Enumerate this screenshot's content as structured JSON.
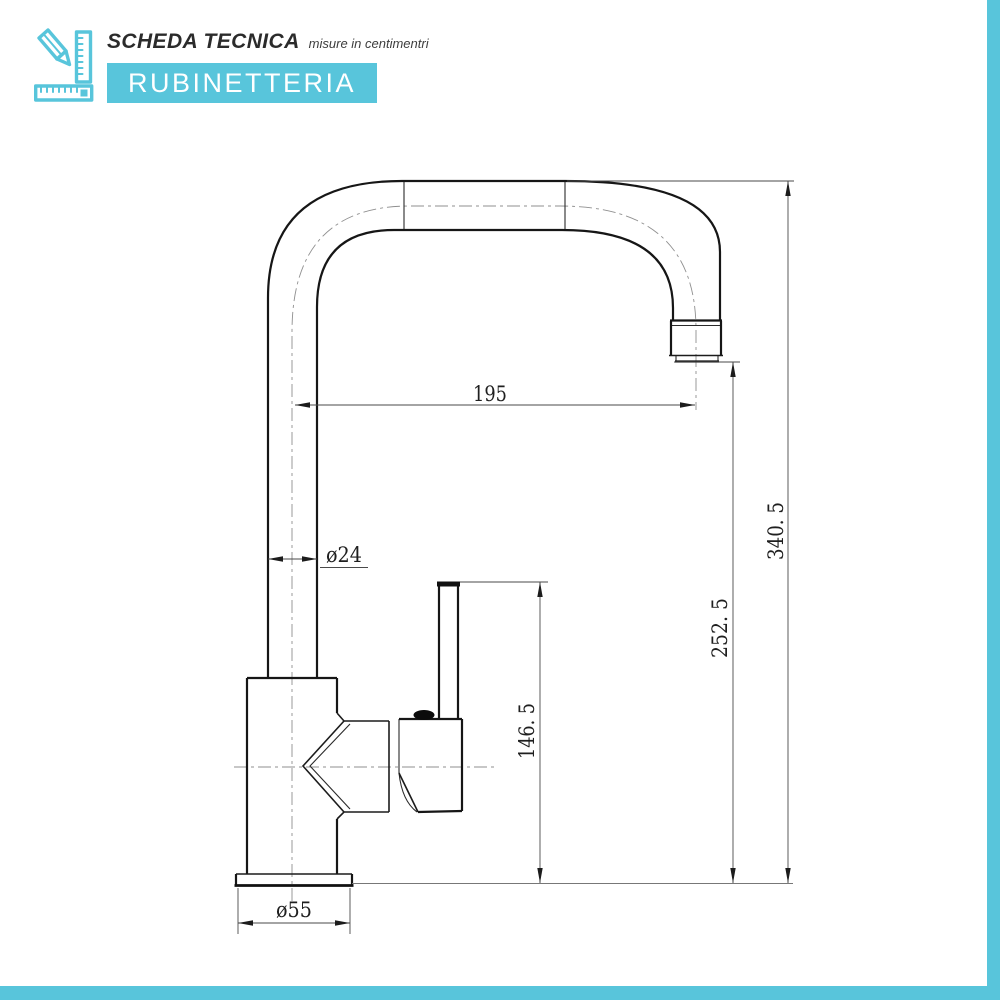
{
  "header": {
    "icon": "pencil-square-ruler-icon",
    "title": "SCHEDA TECNICA",
    "subtitle": "misure in centimentri",
    "banner": "RUBINETTERIA"
  },
  "colors": {
    "accent": "#58c5db",
    "drawing_line": "#161616",
    "dimension_line": "#4a4a4a"
  },
  "drawing": {
    "dims": {
      "spout_reach": {
        "label": "195"
      },
      "pipe_diameter": {
        "label": "ø24"
      },
      "total_height": {
        "label": "340. 5"
      },
      "spout_height": {
        "label": "252. 5"
      },
      "handle_height": {
        "label": "146. 5"
      },
      "base_diameter": {
        "label": "ø55"
      }
    }
  }
}
